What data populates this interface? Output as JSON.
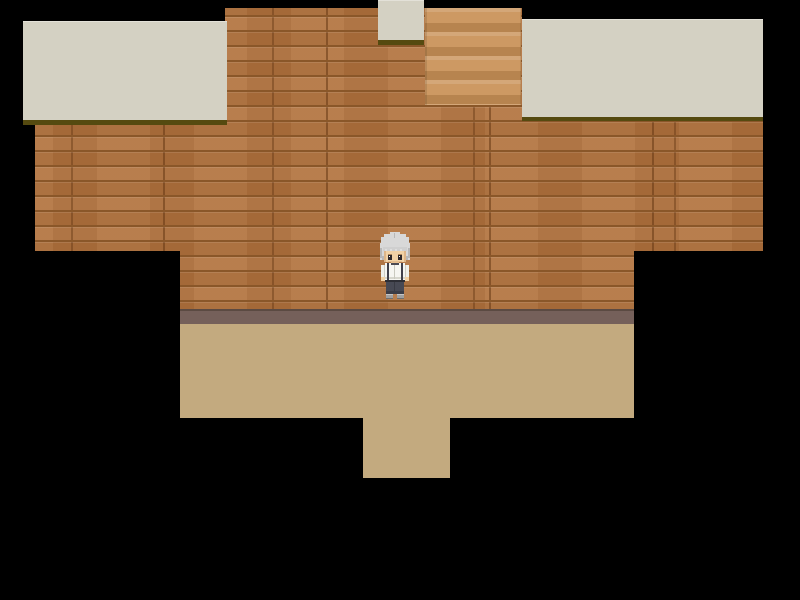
{
  "app": {
    "name": "rpg-room-scene",
    "description": "Top-down RPG game scene: wooden-floored room with staircase, counters and a lower tan-floored area, surrounded by black void"
  },
  "colors": {
    "void": "#000000",
    "wood_base": "#b1723d",
    "wood_seam": "#8a5729",
    "stairs_base": "#c99157",
    "table_surface": "#d4d1c3",
    "table_edge": "#554a10",
    "lower_wall": "#75605a",
    "lower_wall_line": "#5b4a42",
    "tan_floor": "#c3aa7f"
  },
  "scene": {
    "viewport": {
      "width": 800,
      "height": 600
    },
    "regions": [
      {
        "id": "wood-floor-top",
        "label": "wooden plank floor, upper band"
      },
      {
        "id": "wood-floor-main",
        "label": "wooden plank floor, main band"
      },
      {
        "id": "wood-floor-lower",
        "label": "wooden plank floor, lower band"
      },
      {
        "id": "stairs",
        "label": "staircase"
      },
      {
        "id": "table-left",
        "label": "long counter top left"
      },
      {
        "id": "table-top",
        "label": "small counter top center"
      },
      {
        "id": "table-right",
        "label": "long counter top right"
      },
      {
        "id": "lower-wall-base",
        "label": "ledge between wooden floor and lower room"
      },
      {
        "id": "tan-floor",
        "label": "lower room tan floor"
      },
      {
        "id": "tan-floor-exit",
        "label": "lower room doorway floor"
      }
    ],
    "character": {
      "id": "player-character",
      "label": "gray-haired character in white shirt with dark suspenders and dark trousers, facing down",
      "position": {
        "x": 378,
        "y": 232
      },
      "sprite_colors": {
        "hair": "#d8d8d8",
        "hair_shade": "#b7b7b7",
        "skin": "#f1d2a6",
        "eyes": "#2e292b",
        "shirt": "#f5f5f1",
        "suspenders": "#3f3f4a",
        "belt": "#2d2e35",
        "pants": "#474954",
        "shoes": "#a0a0a0"
      }
    }
  }
}
